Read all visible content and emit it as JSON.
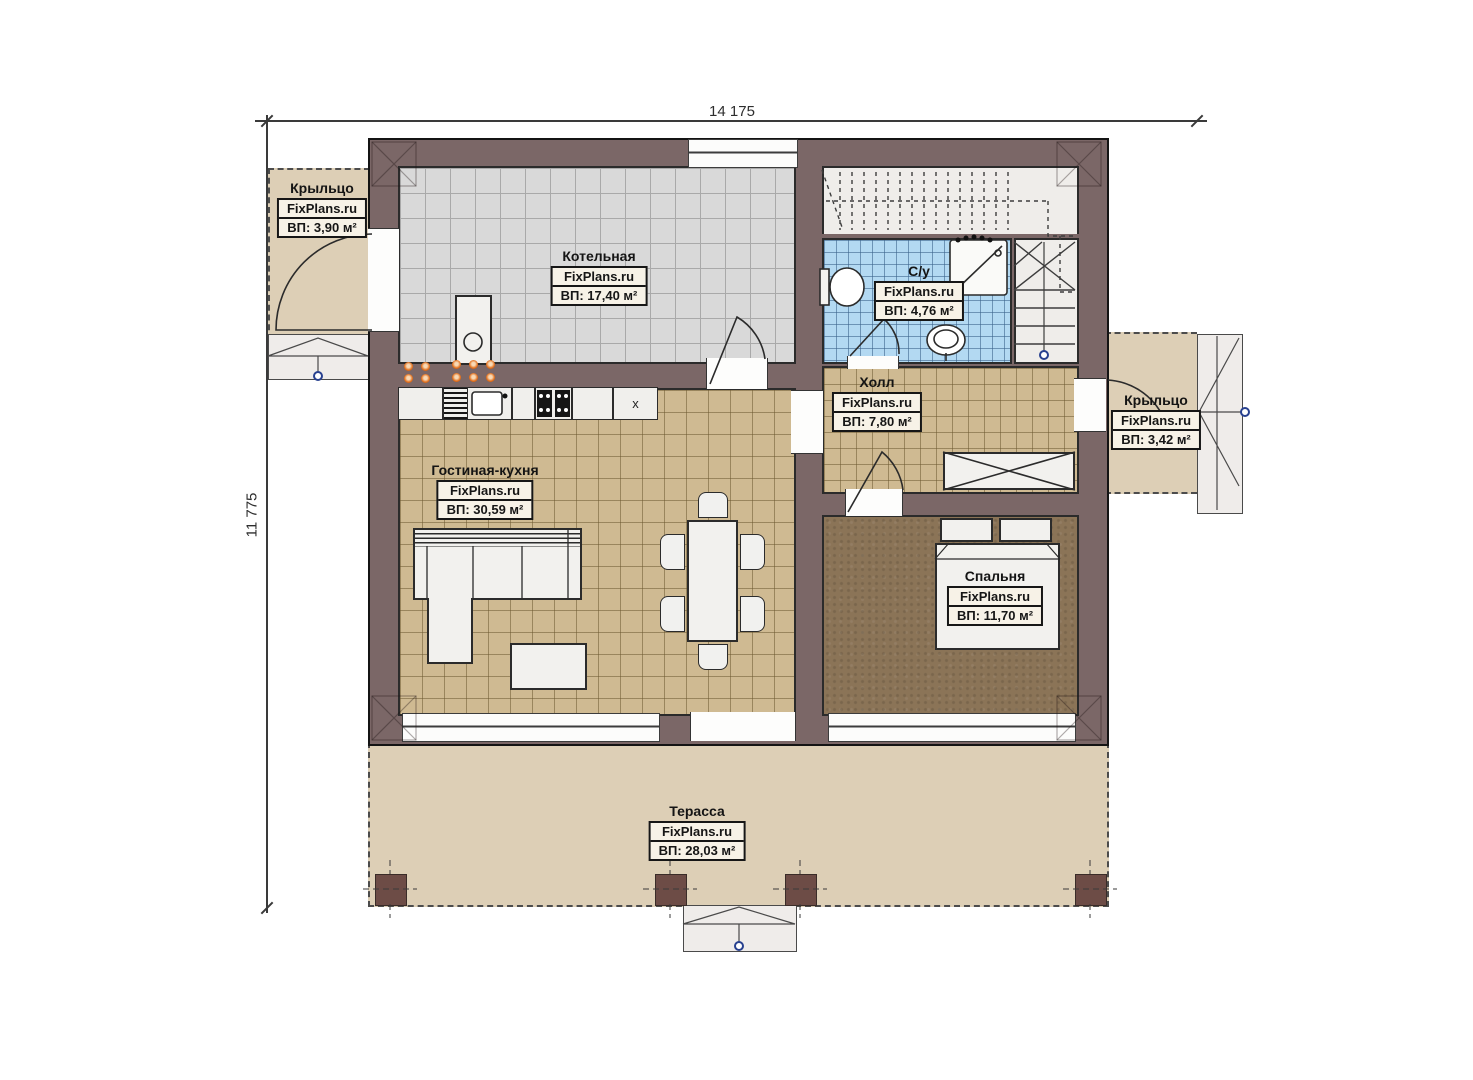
{
  "watermark": "FixPlans.ru",
  "dimensions": {
    "top": "14 175",
    "left": "11 775"
  },
  "rooms": [
    {
      "key": "porch_left",
      "name": "Крыльцо",
      "site": "FixPlans.ru",
      "area": "ВП: 3,90 м²"
    },
    {
      "key": "boiler",
      "name": "Котельная",
      "site": "FixPlans.ru",
      "area": "ВП: 17,40 м²"
    },
    {
      "key": "bathroom",
      "name": "С/у",
      "site": "FixPlans.ru",
      "area": "ВП: 4,76 м²"
    },
    {
      "key": "hall",
      "name": "Холл",
      "site": "FixPlans.ru",
      "area": "ВП: 7,80 м²"
    },
    {
      "key": "porch_right",
      "name": "Крыльцо",
      "site": "FixPlans.ru",
      "area": "ВП: 3,42 м²"
    },
    {
      "key": "living_kitchen",
      "name": "Гостиная-кухня",
      "site": "FixPlans.ru",
      "area": "ВП: 30,59 м²"
    },
    {
      "key": "bedroom",
      "name": "Спальня",
      "site": "FixPlans.ru",
      "area": "ВП: 11,70 м²"
    },
    {
      "key": "terrace",
      "name": "Терасса",
      "site": "FixPlans.ru",
      "area": "ВП: 28,03 м²"
    }
  ],
  "kitchen": {
    "cabinet_x_label": "x"
  },
  "colors": {
    "wall": "#7b6767",
    "outdoor": "#ddcfb6",
    "tile_gray": "#d9d9d9",
    "tile_beige": "#cfba92",
    "tile_blue": "#b3d9f2",
    "bedroom_floor": "#8b7457",
    "accent_orange": "#e2701d",
    "accent_blue": "#27408f"
  }
}
